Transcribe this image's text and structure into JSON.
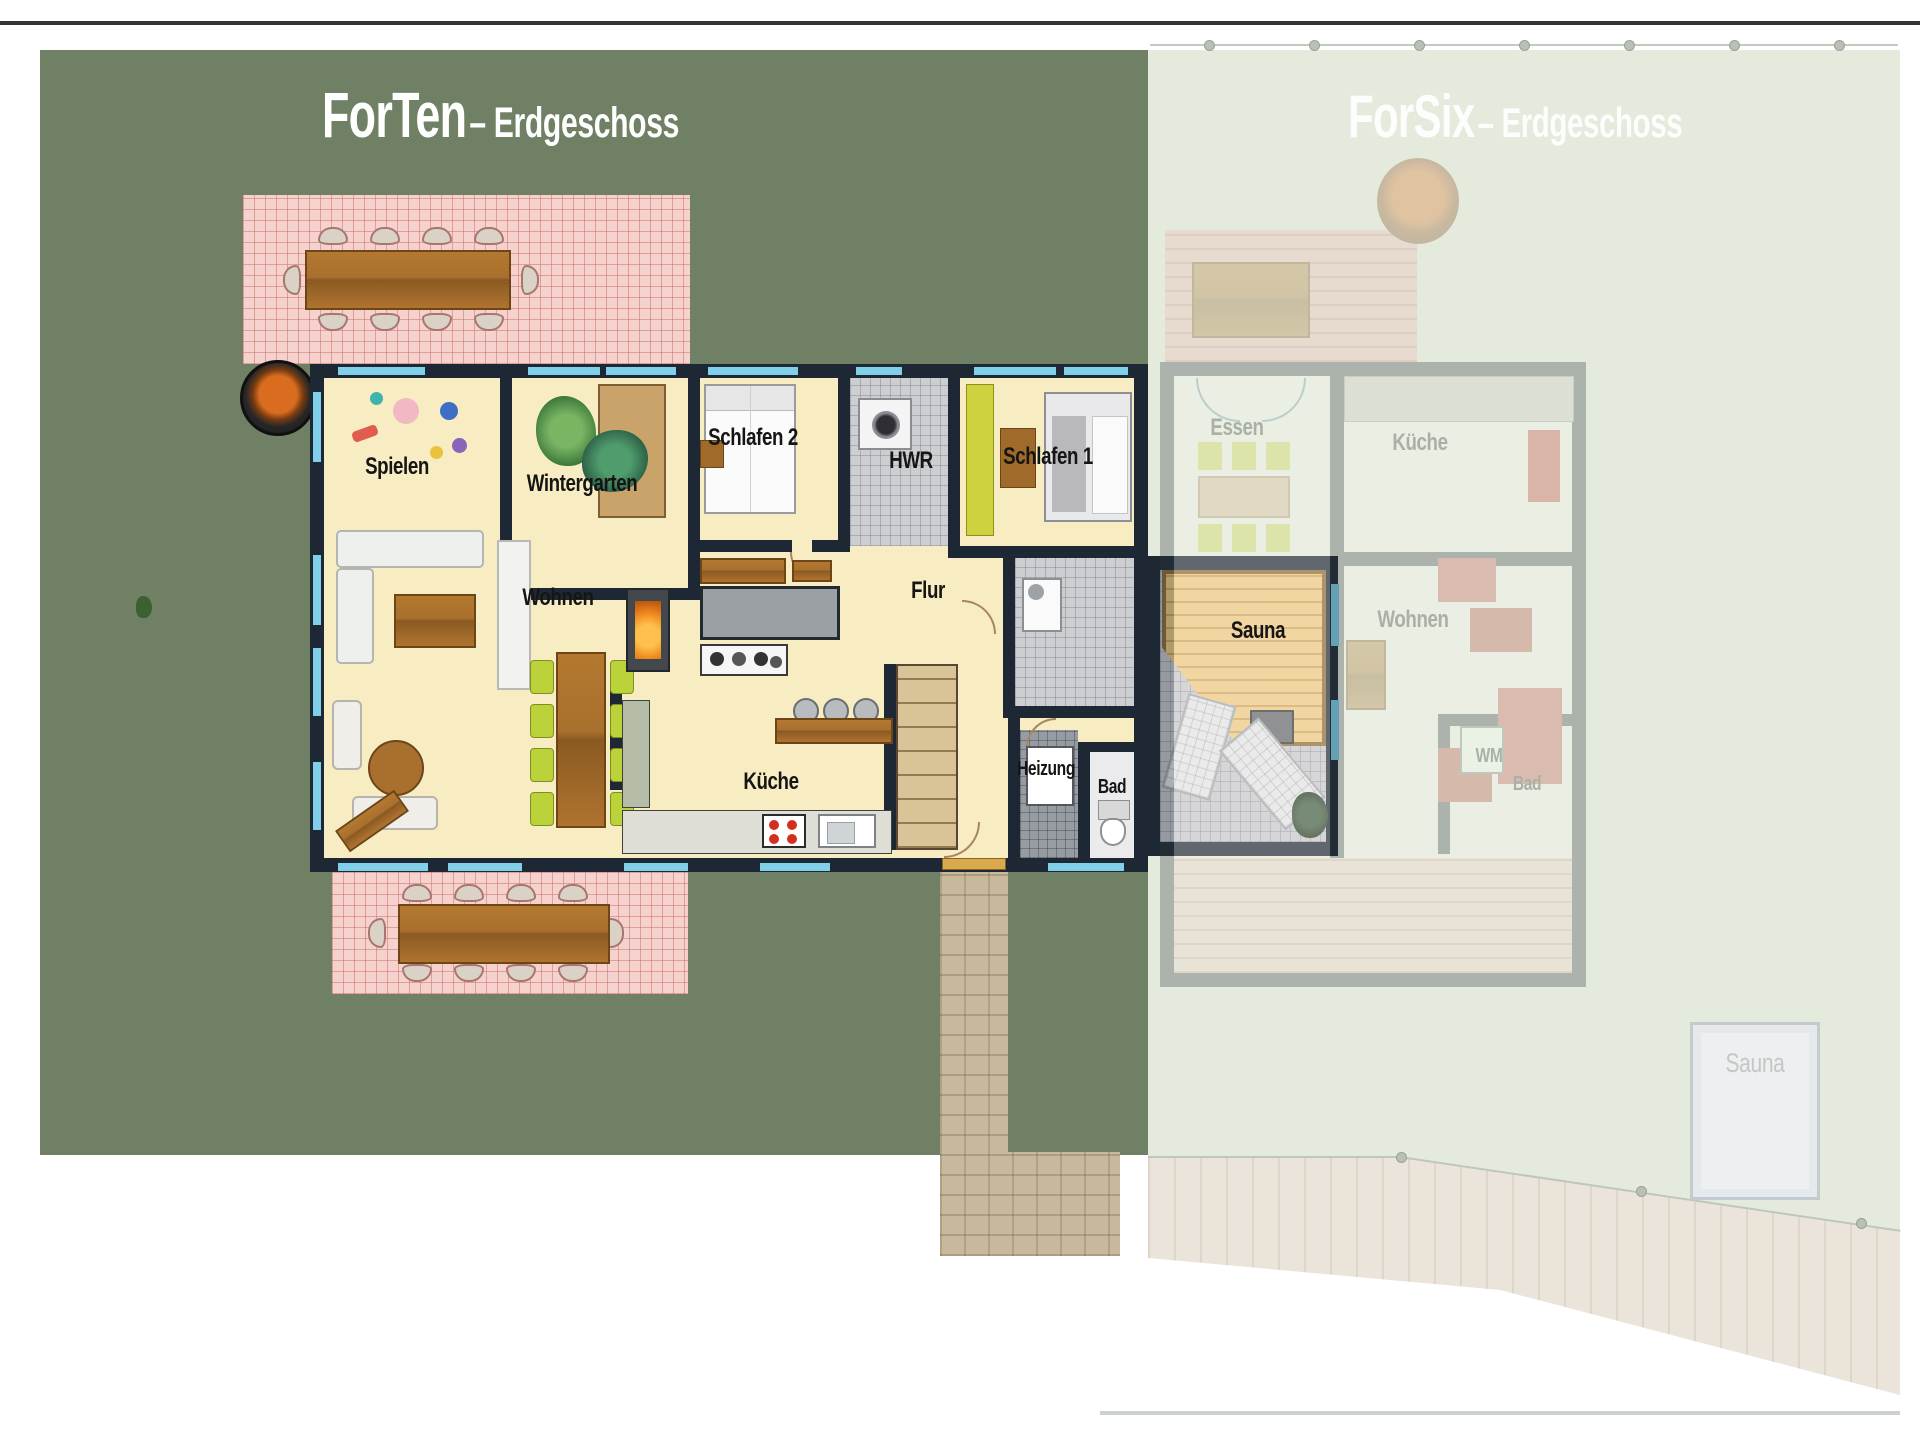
{
  "forten": {
    "title": "ForTen",
    "subtitle": "– Erdgeschoss",
    "rooms": {
      "spielen": "Spielen",
      "wintergarten": "Wintergarten",
      "schlafen2": "Schlafen 2",
      "hwr": "HWR",
      "schlafen1": "Schlafen 1",
      "wohnen": "Wohnen",
      "flur": "Flur",
      "kueche": "Küche",
      "heizung": "Heizung",
      "bad": "Bad",
      "sauna": "Sauna"
    }
  },
  "forsix": {
    "title": "ForSix",
    "subtitle": "– Erdgeschoss",
    "rooms": {
      "essen": "Essen",
      "kueche": "Küche",
      "wohnen": "Wohnen",
      "wm": "WM",
      "bad": "Bad",
      "garden_sauna": "Sauna"
    }
  },
  "colors": {
    "garden-green": "#708064",
    "garden-green-faded": "#e4ebdc",
    "wall-dark": "#1e2834",
    "room-cream": "#f8ecc2",
    "window-blue": "#7fd0e8",
    "terrace-pink": "#f5d2cd",
    "wood": "#a96f2e",
    "tile-gray": "#cdced2",
    "tile-dark": "#979ba2",
    "path-beige": "#c8b99d",
    "lime-chair": "#bcd23a",
    "sauna-wood": "#ecc87e",
    "label-black": "#151515",
    "faded-label": "#a9b0a6",
    "title-white": "#ffffff"
  }
}
